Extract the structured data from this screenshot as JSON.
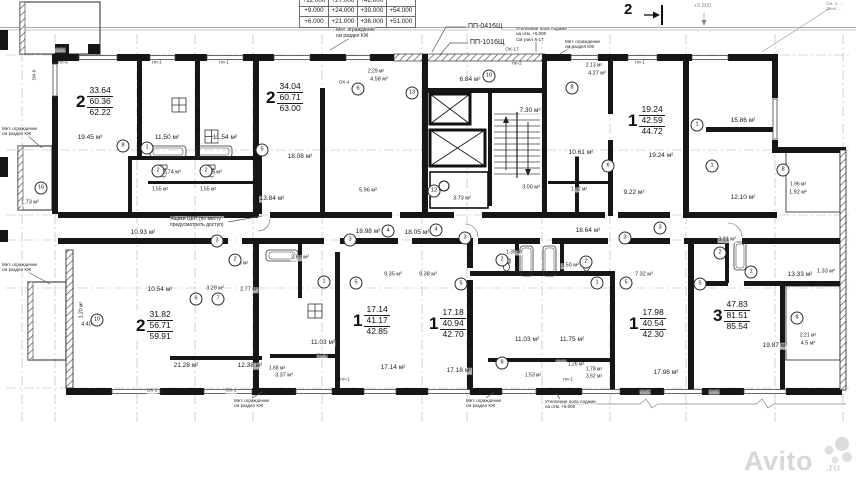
{
  "elevation_table": {
    "rows": [
      [
        "+12.000",
        "+27.000",
        "+42.000",
        ""
      ],
      [
        "+9.000",
        "+24.000",
        "+39.000",
        "+54.000"
      ],
      [
        "+6.000",
        "+21.000",
        "+36.000",
        "+51.000"
      ]
    ]
  },
  "section_marker": {
    "label": "2"
  },
  "watermark": {
    "name": "Avito",
    "domain": ".ru"
  },
  "apartments": [
    {
      "rooms": "2",
      "living": "33.64",
      "area": "60.36",
      "total": "62.22",
      "x": 75,
      "y": 86
    },
    {
      "rooms": "2",
      "living": "34.04",
      "area": "60.71",
      "total": "63.00",
      "x": 265,
      "y": 82
    },
    {
      "rooms": "1",
      "living": "19.24",
      "area": "42.59",
      "total": "44.72",
      "x": 627,
      "y": 105
    },
    {
      "rooms": "2",
      "living": "31.82",
      "area": "56.71",
      "total": "59.91",
      "x": 135,
      "y": 310
    },
    {
      "rooms": "1",
      "living": "17.14",
      "area": "41.17",
      "total": "42.85",
      "x": 352,
      "y": 305
    },
    {
      "rooms": "1",
      "living": "17.18",
      "area": "40.94",
      "total": "42.70",
      "x": 428,
      "y": 308
    },
    {
      "rooms": "1",
      "living": "17.98",
      "area": "40.54",
      "total": "42.30",
      "x": 628,
      "y": 308
    },
    {
      "rooms": "3",
      "living": "47.83",
      "area": "81.51",
      "total": "85.54",
      "x": 712,
      "y": 300
    }
  ],
  "room_labels": [
    {
      "t": "19.45 м²",
      "x": 90,
      "y": 138
    },
    {
      "t": "11.50 м²",
      "x": 167,
      "y": 138
    },
    {
      "t": "11.54 м²",
      "x": 225,
      "y": 138
    },
    {
      "t": "2.74 м²",
      "x": 172,
      "y": 173,
      "fs": 5.5
    },
    {
      "t": "2.75 м²",
      "x": 213,
      "y": 173,
      "fs": 5.5
    },
    {
      "t": "1.55 м²",
      "x": 160,
      "y": 190,
      "fs": 5
    },
    {
      "t": "1.55 м²",
      "x": 208,
      "y": 190,
      "fs": 5
    },
    {
      "t": "1.73 м²",
      "x": 30,
      "y": 203,
      "fs": 5.5
    },
    {
      "t": "18.08 м²",
      "x": 300,
      "y": 157
    },
    {
      "t": "13.84 м²",
      "x": 272,
      "y": 199
    },
    {
      "t": "2.29 м²",
      "x": 376,
      "y": 72,
      "fs": 5
    },
    {
      "t": "4.58 м²",
      "x": 379,
      "y": 80,
      "fs": 5.5
    },
    {
      "t": "5.96 м²",
      "x": 368,
      "y": 191,
      "fs": 5.5
    },
    {
      "t": "6.84 м²",
      "x": 470,
      "y": 80
    },
    {
      "t": "7.30 м²",
      "x": 530,
      "y": 111
    },
    {
      "t": "3.00 м²",
      "x": 531,
      "y": 188,
      "fs": 5.5
    },
    {
      "t": "3.73 м²",
      "x": 462,
      "y": 199,
      "fs": 5.5
    },
    {
      "t": "2.13 м²",
      "x": 594,
      "y": 66,
      "fs": 5
    },
    {
      "t": "4.27 м²",
      "x": 597,
      "y": 74,
      "fs": 5.5
    },
    {
      "t": "10.61 м²",
      "x": 581,
      "y": 153
    },
    {
      "t": "19.24 м²",
      "x": 661,
      "y": 156
    },
    {
      "t": "9.22 м²",
      "x": 634,
      "y": 193
    },
    {
      "t": "1.52 м²",
      "x": 579,
      "y": 190,
      "fs": 5
    },
    {
      "t": "15.86 м²",
      "x": 743,
      "y": 121
    },
    {
      "t": "12.10 м²",
      "x": 743,
      "y": 198
    },
    {
      "t": "1.96 м²",
      "x": 798,
      "y": 185,
      "fs": 5
    },
    {
      "t": "1.92 м²",
      "x": 798,
      "y": 193,
      "fs": 5.5
    },
    {
      "t": "1.33 м²",
      "x": 826,
      "y": 272,
      "fs": 5.5
    },
    {
      "t": "10.93 м²",
      "x": 143,
      "y": 233
    },
    {
      "t": "18.98 м²",
      "x": 368,
      "y": 232
    },
    {
      "t": "18.05 м²",
      "x": 417,
      "y": 233
    },
    {
      "t": "18.64 м²",
      "x": 588,
      "y": 231
    },
    {
      "t": "10.54 м²",
      "x": 160,
      "y": 290
    },
    {
      "t": "3.29 м²",
      "x": 215,
      "y": 289,
      "fs": 5.5
    },
    {
      "t": "2.77 м²",
      "x": 249,
      "y": 290,
      "fs": 5.5
    },
    {
      "t": "1.55 м²",
      "x": 240,
      "y": 264,
      "fs": 5
    },
    {
      "t": "21.28 м²",
      "x": 186,
      "y": 366
    },
    {
      "t": "12.38 м²",
      "x": 250,
      "y": 366
    },
    {
      "t": "1.20 м²",
      "x": 82,
      "y": 310,
      "fs": 5,
      "r": -90
    },
    {
      "t": "4.40 м²",
      "x": 90,
      "y": 325,
      "fs": 5.5
    },
    {
      "t": "9.35 м²",
      "x": 393,
      "y": 275,
      "fs": 5.5
    },
    {
      "t": "9.38 м²",
      "x": 428,
      "y": 275,
      "fs": 5.5
    },
    {
      "t": "3.65 м²",
      "x": 300,
      "y": 258,
      "fs": 5.5
    },
    {
      "t": "11.03 м²",
      "x": 323,
      "y": 343
    },
    {
      "t": "3.37 м²",
      "x": 284,
      "y": 376,
      "fs": 5.5
    },
    {
      "t": "1.68 м²",
      "x": 277,
      "y": 369,
      "fs": 5
    },
    {
      "t": "17.14 м²",
      "x": 393,
      "y": 368
    },
    {
      "t": "17.18 м²",
      "x": 459,
      "y": 371
    },
    {
      "t": "3.50 м²",
      "x": 570,
      "y": 266,
      "fs": 5.5
    },
    {
      "t": "1.35 м²",
      "x": 514,
      "y": 253,
      "fs": 5
    },
    {
      "t": "7.32 м²",
      "x": 644,
      "y": 275,
      "fs": 5.5
    },
    {
      "t": "11.03 м²",
      "x": 527,
      "y": 340
    },
    {
      "t": "11.75 м²",
      "x": 572,
      "y": 340
    },
    {
      "t": "1.26 м²",
      "x": 576,
      "y": 365,
      "fs": 5
    },
    {
      "t": "1.53 м²",
      "x": 533,
      "y": 376,
      "fs": 5
    },
    {
      "t": "1.78 м²",
      "x": 594,
      "y": 370,
      "fs": 5
    },
    {
      "t": "3.62 м²",
      "x": 594,
      "y": 377,
      "fs": 5
    },
    {
      "t": "17.98 м²",
      "x": 666,
      "y": 373
    },
    {
      "t": "3.21 м²",
      "x": 727,
      "y": 240,
      "fs": 5.5
    },
    {
      "t": "13.33 м²",
      "x": 800,
      "y": 275
    },
    {
      "t": "19.87 м²",
      "x": 775,
      "y": 346
    },
    {
      "t": "2.21 м²",
      "x": 808,
      "y": 336,
      "fs": 5
    },
    {
      "t": "4.5 м²",
      "x": 808,
      "y": 344,
      "fs": 5.5
    }
  ],
  "annotations": [
    {
      "lines": [
        "Мет. ограждение",
        "см раздел КЖ"
      ],
      "x": 336,
      "y": 27,
      "fs": 5
    },
    {
      "lines": [
        "ПП-0416Щ"
      ],
      "x": 468,
      "y": 23,
      "fs": 7
    },
    {
      "lines": [
        "ПП-1016Щ"
      ],
      "x": 470,
      "y": 39,
      "fs": 7
    },
    {
      "lines": [
        "Утепление пола лоджии",
        "на отм. +6.000",
        "См узел А-17"
      ],
      "x": 516,
      "y": 26,
      "fs": 4.5
    },
    {
      "lines": [
        "Мет. ограждение",
        "см раздел КЖ"
      ],
      "x": 565,
      "y": 39,
      "fs": 4.5
    },
    {
      "lines": [
        "См. п. ...",
        "Дане ..."
      ],
      "x": 826,
      "y": 1,
      "fs": 4.5,
      "gray": true
    },
    {
      "lines": [
        "+5.800"
      ],
      "x": 694,
      "y": 3,
      "fs": 5.5,
      "gray": true
    },
    {
      "lines": [
        "Мет. ограждение",
        "см раздел КЖ"
      ],
      "x": 2,
      "y": 126,
      "fs": 4.5
    },
    {
      "lines": [
        "Мет. ограждение",
        "см раздел КЖ"
      ],
      "x": 2,
      "y": 262,
      "fs": 4.5
    },
    {
      "lines": [
        "Ящики ЦЕП (по месту",
        "предусмотреть доступ)"
      ],
      "x": 170,
      "y": 216,
      "fs": 5
    },
    {
      "lines": [
        "Мет. ограждение",
        "см раздел КЖ"
      ],
      "x": 234,
      "y": 398,
      "fs": 4.5
    },
    {
      "lines": [
        "Мет. ограждение",
        "см раздел КЖ"
      ],
      "x": 466,
      "y": 398,
      "fs": 4.5
    },
    {
      "lines": [
        "Утепление пола лоджии",
        "на отм. +6.000"
      ],
      "x": 545,
      "y": 399,
      "fs": 4.5
    }
  ],
  "window_tags": [
    {
      "t": "ОК-6",
      "x": 60,
      "y": 50
    },
    {
      "t": "ОК-6",
      "x": 36,
      "y": 75,
      "r": -90
    },
    {
      "t": "пл-6",
      "x": 63,
      "y": 64
    },
    {
      "t": "пл-1",
      "x": 157,
      "y": 64
    },
    {
      "t": "пл-1",
      "x": 224,
      "y": 64
    },
    {
      "t": "ОК-4",
      "x": 344,
      "y": 84
    },
    {
      "t": "пп-2",
      "x": 517,
      "y": 65
    },
    {
      "t": "ОК-17",
      "x": 512,
      "y": 51
    },
    {
      "t": "пл-1",
      "x": 640,
      "y": 64
    },
    {
      "t": "ОК-1",
      "x": 152,
      "y": 392
    },
    {
      "t": "ОК-1",
      "x": 231,
      "y": 392
    },
    {
      "t": "ОК-1",
      "x": 645,
      "y": 392
    },
    {
      "t": "ОК-1",
      "x": 714,
      "y": 392
    },
    {
      "t": "ОК-4",
      "x": 322,
      "y": 357
    },
    {
      "t": "ОК-4",
      "x": 561,
      "y": 362
    },
    {
      "t": "пл-1",
      "x": 345,
      "y": 381
    },
    {
      "t": "пл-1",
      "x": 568,
      "y": 381
    }
  ],
  "grid_bubbles": [
    {
      "n": "8",
      "x": 123,
      "y": 146
    },
    {
      "n": "1",
      "x": 147,
      "y": 148
    },
    {
      "n": "2",
      "x": 158,
      "y": 171
    },
    {
      "n": "2",
      "x": 206,
      "y": 171
    },
    {
      "n": "5",
      "x": 262,
      "y": 150
    },
    {
      "n": "6",
      "x": 358,
      "y": 89
    },
    {
      "n": "13",
      "x": 412,
      "y": 93
    },
    {
      "n": "10",
      "x": 489,
      "y": 76
    },
    {
      "n": "12",
      "x": 434,
      "y": 191
    },
    {
      "n": "8",
      "x": 572,
      "y": 88
    },
    {
      "n": "6",
      "x": 608,
      "y": 166
    },
    {
      "n": "1",
      "x": 697,
      "y": 125
    },
    {
      "n": "1",
      "x": 712,
      "y": 166
    },
    {
      "n": "8",
      "x": 783,
      "y": 170
    },
    {
      "n": "16",
      "x": 41,
      "y": 188
    },
    {
      "n": "3",
      "x": 217,
      "y": 241
    },
    {
      "n": "2",
      "x": 235,
      "y": 260
    },
    {
      "n": "6",
      "x": 196,
      "y": 299
    },
    {
      "n": "7",
      "x": 218,
      "y": 299
    },
    {
      "n": "3",
      "x": 350,
      "y": 240
    },
    {
      "n": "4",
      "x": 388,
      "y": 231
    },
    {
      "n": "4",
      "x": 436,
      "y": 230
    },
    {
      "n": "3",
      "x": 465,
      "y": 238
    },
    {
      "n": "1",
      "x": 324,
      "y": 282
    },
    {
      "n": "5",
      "x": 356,
      "y": 283
    },
    {
      "n": "5",
      "x": 461,
      "y": 284
    },
    {
      "n": "2",
      "x": 502,
      "y": 260
    },
    {
      "n": "2",
      "x": 586,
      "y": 262
    },
    {
      "n": "1",
      "x": 597,
      "y": 283
    },
    {
      "n": "5",
      "x": 626,
      "y": 283
    },
    {
      "n": "3",
      "x": 625,
      "y": 238
    },
    {
      "n": "3",
      "x": 660,
      "y": 228
    },
    {
      "n": "8",
      "x": 502,
      "y": 363
    },
    {
      "n": "5",
      "x": 700,
      "y": 284
    },
    {
      "n": "2",
      "x": 720,
      "y": 253
    },
    {
      "n": "1",
      "x": 751,
      "y": 272
    },
    {
      "n": "8",
      "x": 797,
      "y": 318
    },
    {
      "n": "10",
      "x": 97,
      "y": 320
    }
  ]
}
